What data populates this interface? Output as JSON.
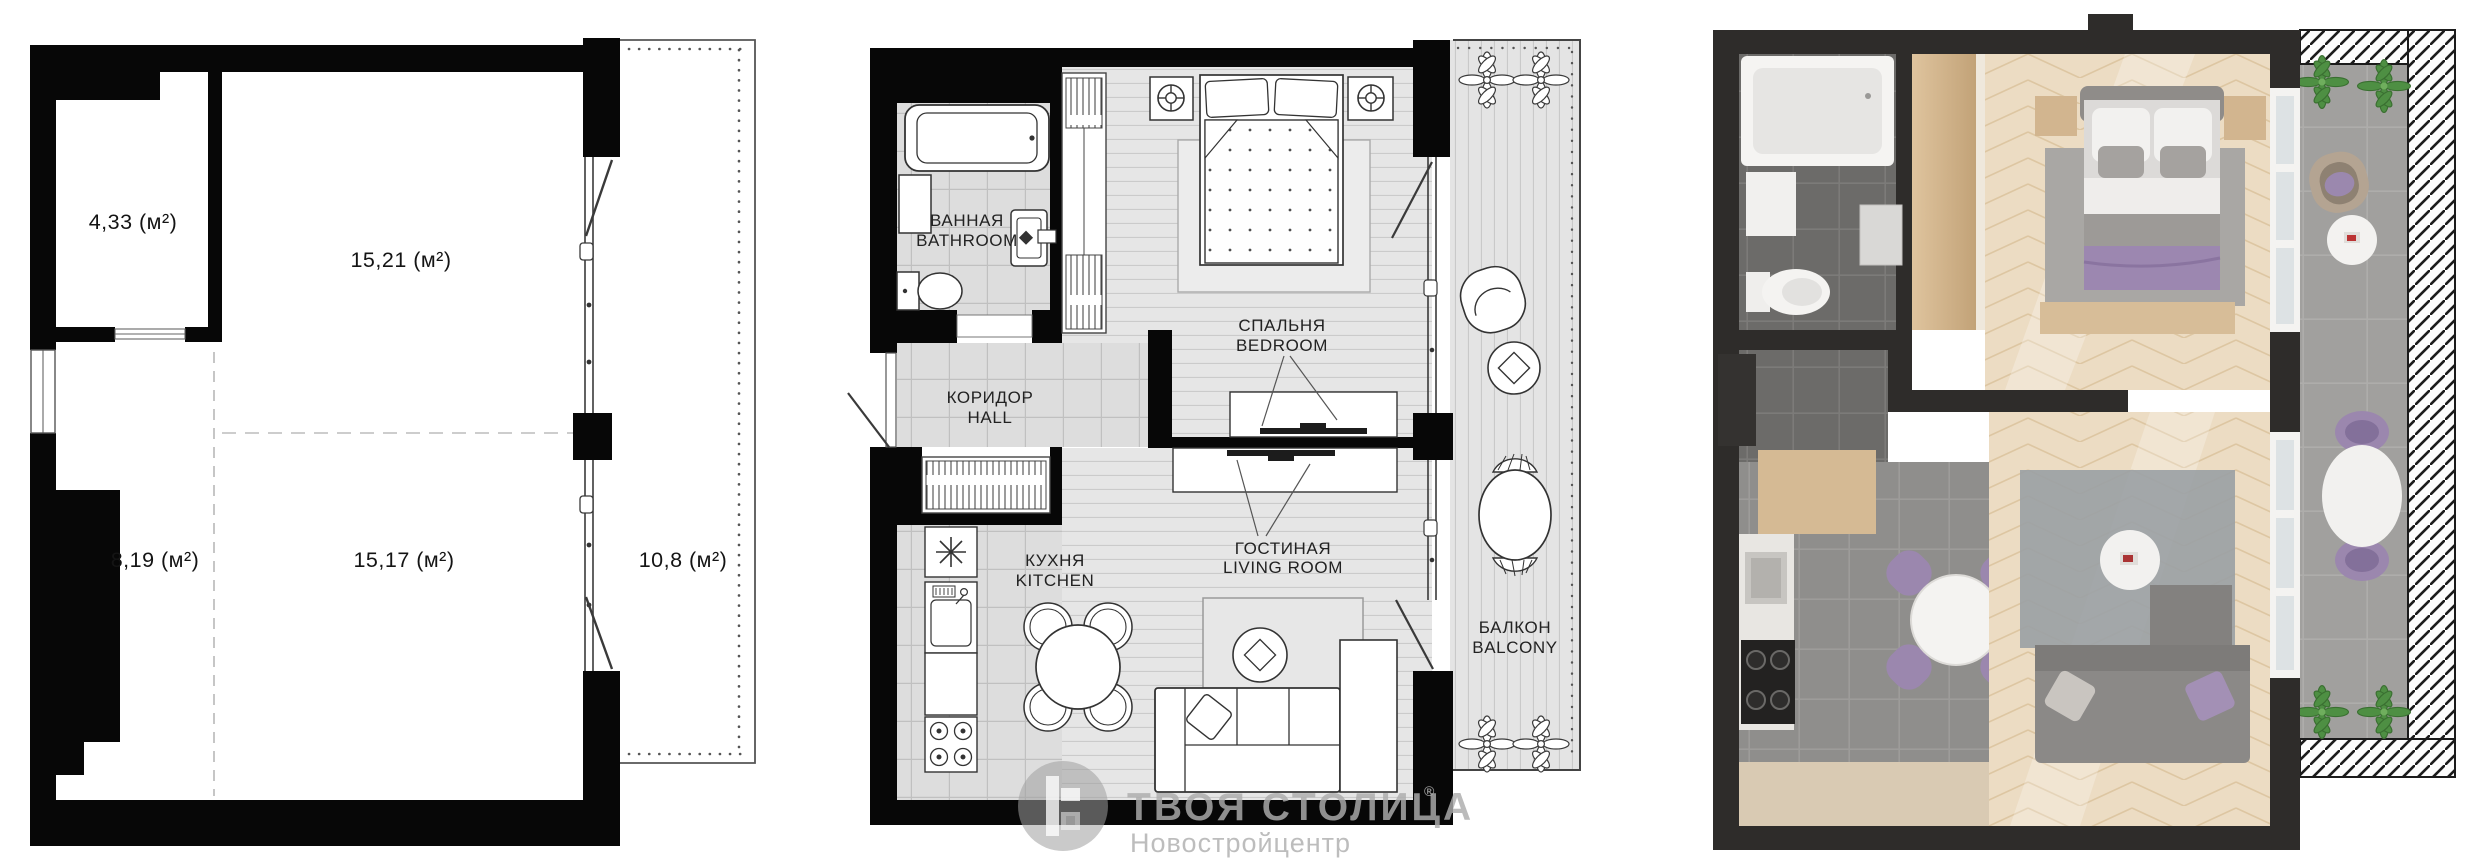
{
  "plans": {
    "schematic": {
      "name": "schematic plan with areas",
      "areas": [
        {
          "id": "storage",
          "label": "4,33 (м²)"
        },
        {
          "id": "room-top",
          "label": "15,21 (м²)"
        },
        {
          "id": "room-left",
          "label": "8,19 (м²)"
        },
        {
          "id": "room-bottom",
          "label": "15,17 (м²)"
        },
        {
          "id": "balcony",
          "label": "10,8 (м²)"
        }
      ]
    },
    "detailed": {
      "name": "detailed furnished plan",
      "rooms": [
        {
          "id": "bathroom",
          "label_ru": "ВАННАЯ",
          "label_en": "BATHROOM"
        },
        {
          "id": "hall",
          "label_ru": "КОРИДОР",
          "label_en": "HALL"
        },
        {
          "id": "bedroom",
          "label_ru": "СПАЛЬНЯ",
          "label_en": "BEDROOM"
        },
        {
          "id": "kitchen",
          "label_ru": "КУХНЯ",
          "label_en": "KITCHEN"
        },
        {
          "id": "living_room",
          "label_ru": "ГОСТИНАЯ",
          "label_en": "LIVING ROOM"
        },
        {
          "id": "balcony",
          "label_ru": "БАЛКОН",
          "label_en": "BALCONY"
        }
      ]
    },
    "render3d": {
      "name": "3d top-down render"
    }
  },
  "watermark": {
    "brand": "ТВОЯ СТОЛИЦА",
    "registered": "®",
    "subtitle": "Новостройцентр"
  },
  "colors": {
    "plan_line": "#000000",
    "wall_dark_3d": "#2e2c2a",
    "floor_beige": "#ead9c0",
    "accent_purple": "#9c87b0",
    "plant_green": "#4e8f43",
    "watermark_gray": "#b0b0b0"
  }
}
